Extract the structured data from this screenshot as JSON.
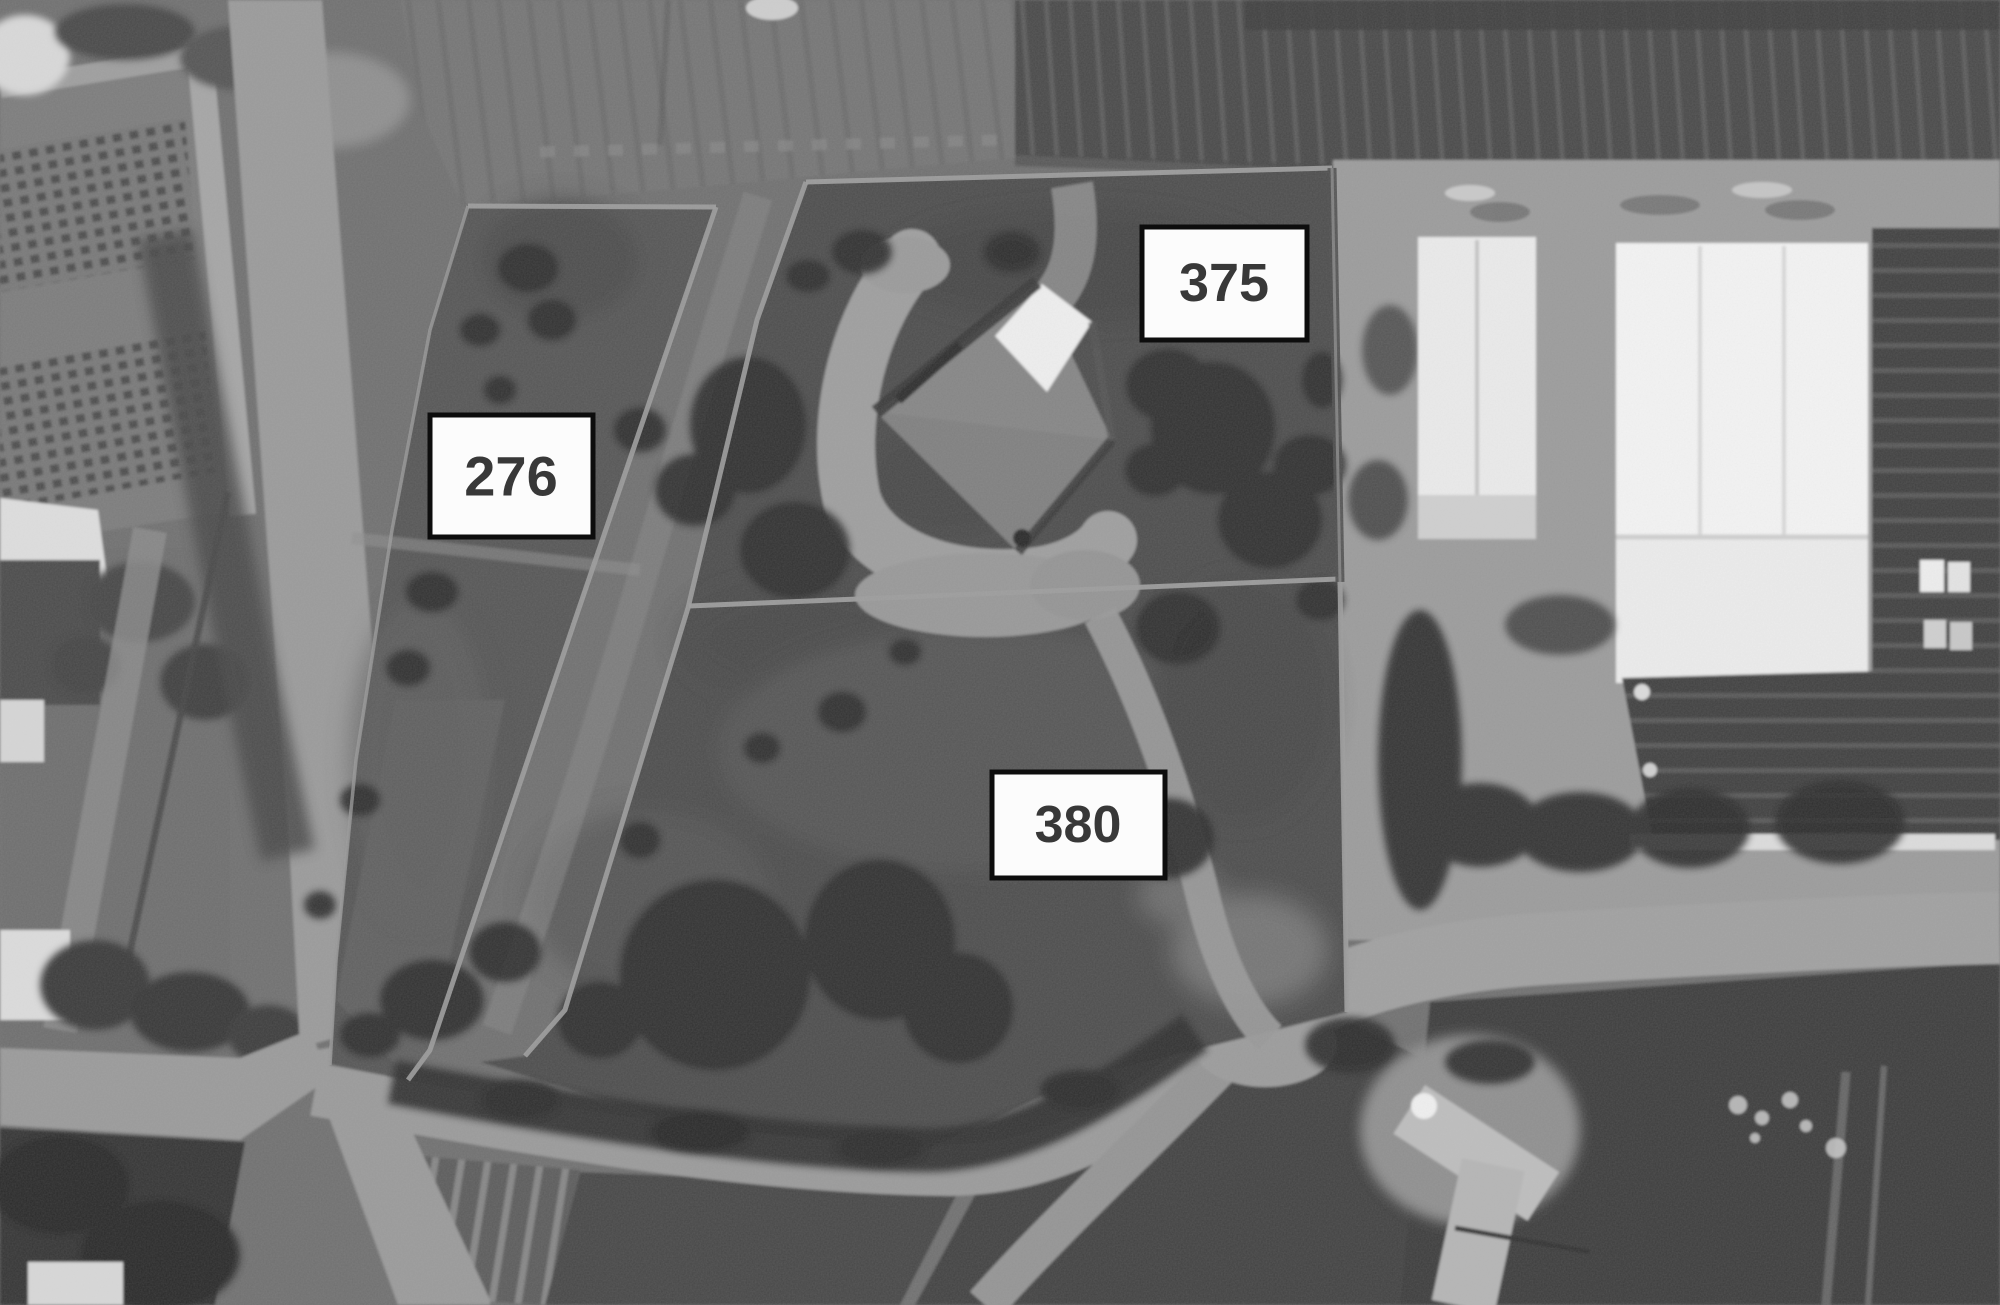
{
  "map": {
    "kind": "grayscale-aerial-orthophoto-with-cadastral-overlay",
    "labels": [
      {
        "value": "276"
      },
      {
        "value": "375"
      },
      {
        "value": "380"
      }
    ],
    "label_style": {
      "background": "#fcfcfc",
      "border": "#0d0d0d",
      "text_color": "#383838"
    },
    "boundary_color": "#9c9c9c"
  }
}
